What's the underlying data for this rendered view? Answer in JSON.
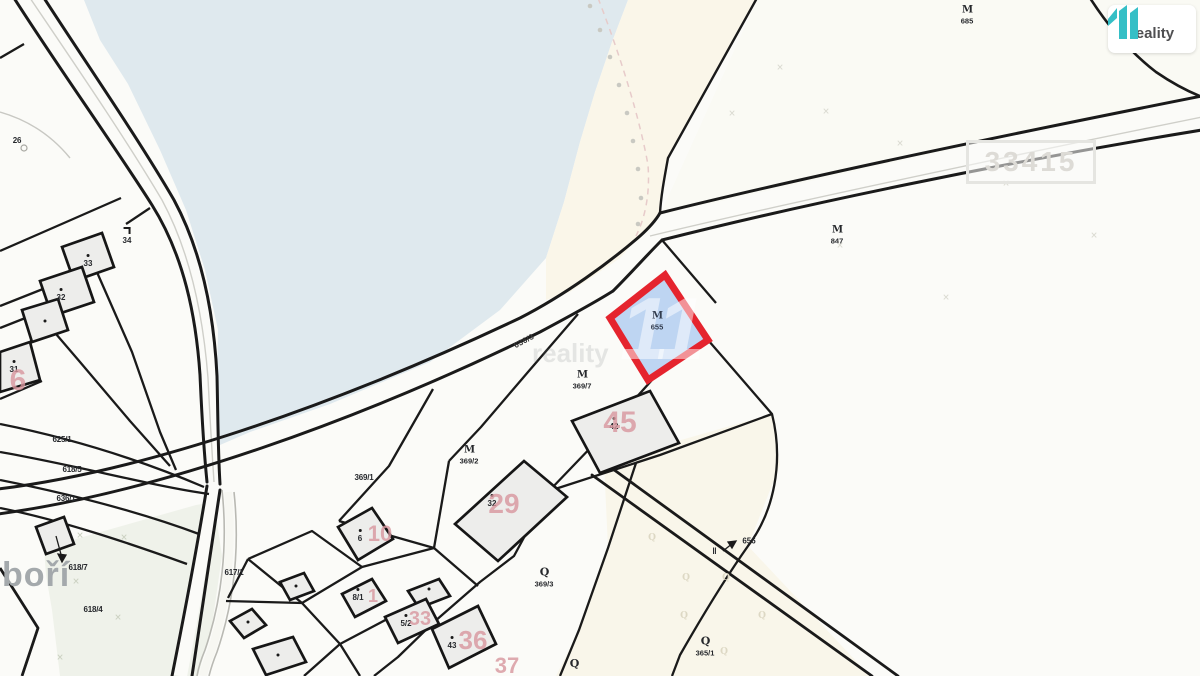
{
  "branding": {
    "logo_text": "reality",
    "logo_number": "11",
    "logo_color": "#35bfc6"
  },
  "map": {
    "sheet_number": "33415",
    "place_name": "boří",
    "road_label": "636/3",
    "watermark": {
      "text": "reality",
      "number": "11"
    },
    "highlight": {
      "symbol": "М",
      "number": "655",
      "stroke": "#e5242e",
      "fill": "#82afeb"
    },
    "pointer": {
      "symbol": "‖",
      "number": "656"
    },
    "arrow_target_label": "618/7",
    "colors": {
      "water": "#dfe9ee",
      "cream": "#faf6e9",
      "green": "#eff2ea",
      "building": "#ededeb",
      "line": "#1a1a1a",
      "red_number": "#d8969e"
    },
    "parcel_labels": [
      {
        "t": "26",
        "x": 17,
        "y": 141
      },
      {
        "t": "625/1",
        "x": 62,
        "y": 440
      },
      {
        "t": "618/5",
        "x": 72,
        "y": 470
      },
      {
        "t": "636/1",
        "x": 66,
        "y": 499
      },
      {
        "t": "618/7",
        "x": 78,
        "y": 568
      },
      {
        "t": "618/4",
        "x": 93,
        "y": 610
      },
      {
        "t": "617/1",
        "x": 234,
        "y": 573
      },
      {
        "t": "369/1",
        "x": 364,
        "y": 478
      }
    ],
    "symbol_labels": [
      {
        "s": "М",
        "t": "685",
        "x": 967,
        "y": 15
      },
      {
        "s": "М",
        "t": "847",
        "x": 837,
        "y": 235
      },
      {
        "s": "М",
        "t": "655",
        "x": 657,
        "y": 321,
        "hl": true
      },
      {
        "s": "М",
        "t": "369/7",
        "x": 582,
        "y": 380
      },
      {
        "s": "М",
        "t": "369/2",
        "x": 469,
        "y": 455
      },
      {
        "s": "Q",
        "t": "369/3",
        "x": 544,
        "y": 577,
        "q": true
      },
      {
        "s": "Q",
        "t": "365/1",
        "x": 705,
        "y": 646,
        "q": true
      },
      {
        "s": "Q",
        "t": "",
        "x": 574,
        "y": 664,
        "q": true
      }
    ],
    "building_labels": [
      {
        "t": "33",
        "x": 88,
        "y": 261
      },
      {
        "t": "32",
        "x": 61,
        "y": 295
      },
      {
        "t": "31",
        "x": 14,
        "y": 367
      },
      {
        "t": "",
        "x": 45,
        "y": 321
      },
      {
        "t": "34",
        "x": 127,
        "y": 236,
        "corner": true
      },
      {
        "t": "42",
        "x": 614,
        "y": 424
      },
      {
        "t": "32",
        "x": 492,
        "y": 501
      },
      {
        "t": "6",
        "x": 360,
        "y": 536
      },
      {
        "t": "8/1",
        "x": 358,
        "y": 595
      },
      {
        "t": "5/2",
        "x": 406,
        "y": 621
      },
      {
        "t": "43",
        "x": 452,
        "y": 643
      },
      {
        "t": "",
        "x": 296,
        "y": 586
      },
      {
        "t": "",
        "x": 248,
        "y": 622
      },
      {
        "t": "",
        "x": 429,
        "y": 589
      },
      {
        "t": "",
        "x": 278,
        "y": 655
      }
    ],
    "red_numbers": [
      {
        "t": "6",
        "x": 18,
        "y": 381,
        "fs": 30
      },
      {
        "t": "10",
        "x": 380,
        "y": 534,
        "fs": 22
      },
      {
        "t": "29",
        "x": 504,
        "y": 504,
        "fs": 28
      },
      {
        "t": "45",
        "x": 620,
        "y": 423,
        "fs": 30
      },
      {
        "t": "1",
        "x": 373,
        "y": 596,
        "fs": 18
      },
      {
        "t": "33",
        "x": 420,
        "y": 619,
        "fs": 20
      },
      {
        "t": "36",
        "x": 473,
        "y": 640,
        "fs": 26
      },
      {
        "t": "37",
        "x": 507,
        "y": 666,
        "fs": 22
      }
    ],
    "faint_marks": [
      {
        "g": "×",
        "x": 780,
        "y": 68
      },
      {
        "g": "×",
        "x": 826,
        "y": 112
      },
      {
        "g": "×",
        "x": 732,
        "y": 114
      },
      {
        "g": "×",
        "x": 900,
        "y": 144
      },
      {
        "g": "×",
        "x": 1006,
        "y": 184
      },
      {
        "g": "×",
        "x": 1094,
        "y": 236
      },
      {
        "g": "×",
        "x": 840,
        "y": 246
      },
      {
        "g": "×",
        "x": 946,
        "y": 298
      },
      {
        "g": "×",
        "x": 80,
        "y": 536,
        "c": "#ccd2c2"
      },
      {
        "g": "×",
        "x": 124,
        "y": 538,
        "c": "#ccd2c2"
      },
      {
        "g": "×",
        "x": 76,
        "y": 582,
        "c": "#ccd2c2"
      },
      {
        "g": "×",
        "x": 118,
        "y": 618,
        "c": "#ccd2c2"
      },
      {
        "g": "×",
        "x": 60,
        "y": 658,
        "c": "#ccd2c2"
      },
      {
        "g": "Q",
        "x": 652,
        "y": 538,
        "c": "#ddd8c4"
      },
      {
        "g": "Q",
        "x": 686,
        "y": 578,
        "c": "#ddd8c4"
      },
      {
        "g": "Q",
        "x": 726,
        "y": 578,
        "c": "#ddd8c4"
      },
      {
        "g": "Q",
        "x": 684,
        "y": 616,
        "c": "#ddd8c4"
      },
      {
        "g": "Q",
        "x": 762,
        "y": 616,
        "c": "#ddd8c4"
      },
      {
        "g": "Q",
        "x": 724,
        "y": 652,
        "c": "#ddd8c4"
      }
    ]
  }
}
